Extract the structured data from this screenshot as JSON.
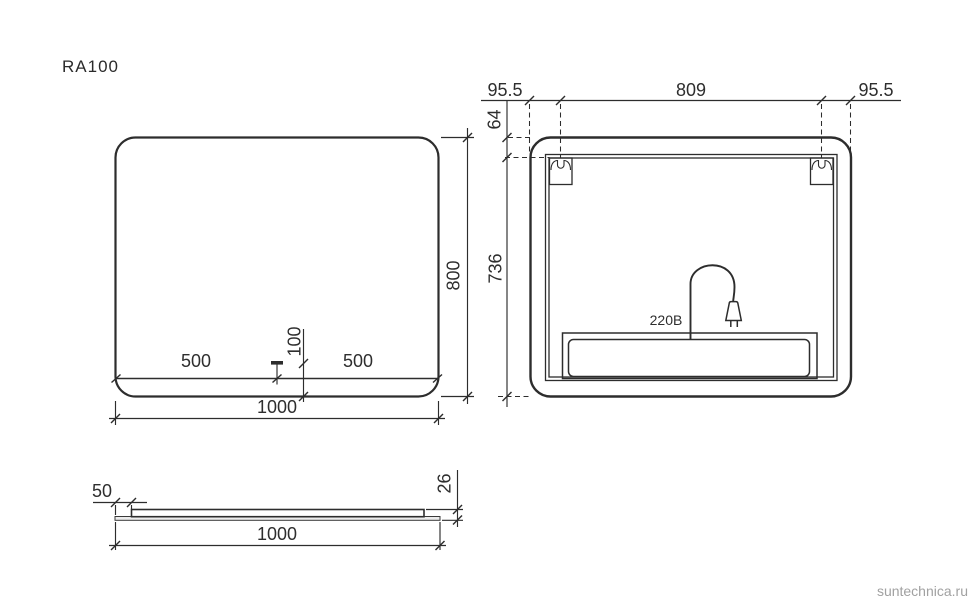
{
  "title": "RA100",
  "watermark": "suntechnica.ru",
  "front_view": {
    "dim_width": "1000",
    "dim_height": "800",
    "dim_left_half": "500",
    "dim_right_half": "500",
    "dim_sensor_height": "100"
  },
  "rear_view": {
    "dim_left_offset": "95.5",
    "dim_bracket_span": "809",
    "dim_right_offset": "95.5",
    "dim_top_offset": "64",
    "dim_bracket_to_bottom": "736",
    "voltage_label": "220В"
  },
  "side_view": {
    "dim_edge_inset": "50",
    "dim_thickness": "26",
    "dim_width": "1000"
  }
}
